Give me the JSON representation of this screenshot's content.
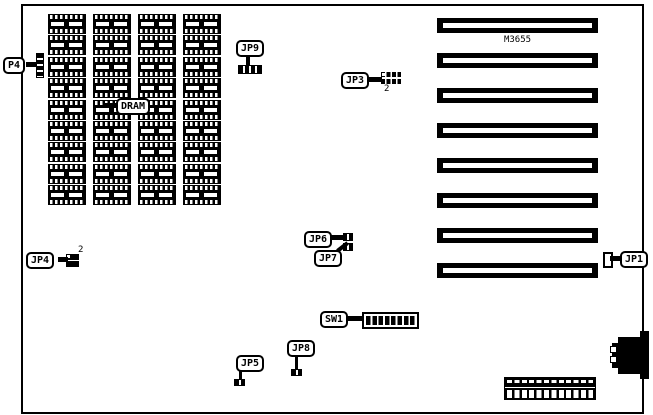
{
  "board": {
    "model_label": "M3655",
    "dram_region_label": "DRAM",
    "dram_grid": {
      "columns": 4,
      "rows": 9
    },
    "slots": {
      "count": 8
    },
    "dip_switch": {
      "segments": 8
    },
    "callouts": {
      "p4": "P4",
      "jp9": "JP9",
      "jp3": "JP3",
      "jp4": "JP4",
      "jp6": "JP6",
      "jp7": "JP7",
      "jp5": "JP5",
      "jp8": "JP8",
      "jp1": "JP1",
      "sw1": "SW1"
    },
    "pin_annotations": {
      "jp3_pin": "2",
      "jp4_pin": "2"
    },
    "colors": {
      "ink": "#000000",
      "background": "#ffffff"
    }
  }
}
